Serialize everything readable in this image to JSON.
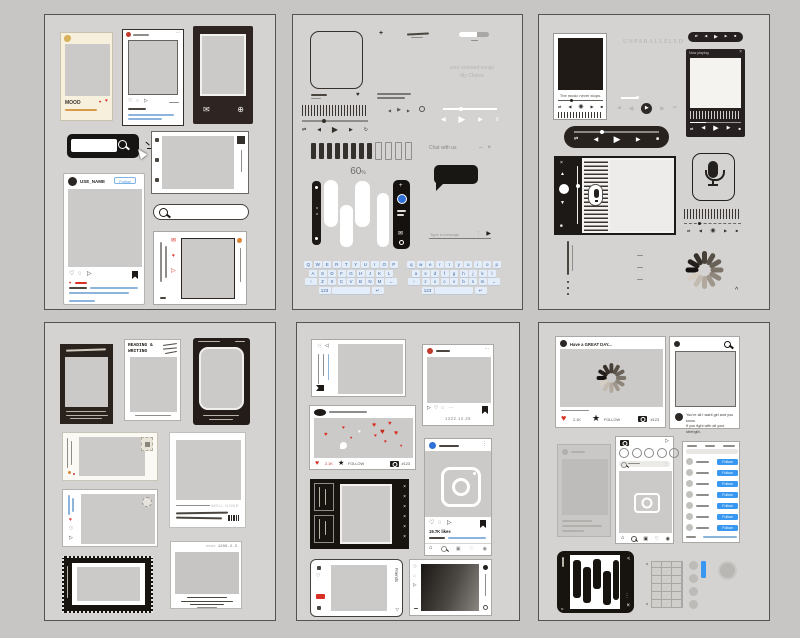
{
  "icons": {
    "heart": "♥",
    "heart_outline": "♡",
    "star": "★",
    "play": "▶",
    "prev": "◀",
    "next": "▶",
    "stop": "■",
    "shuffle": "⇄",
    "repeat": "↻",
    "record": "◉",
    "menu": "≡",
    "dots": "···",
    "dots_v": "⋮",
    "close": "×",
    "minimize": "–",
    "plus": "+",
    "envelope": "✉",
    "globe": "⊕",
    "home": "⌂",
    "circle": "○",
    "grid": "▣",
    "person": "◉",
    "up": "▲",
    "down": "▼",
    "down_outline": "▽",
    "caret": "^",
    "send": "▶",
    "comment": "◌",
    "share": "▷"
  },
  "sheet1": {
    "polaroid_title": "MOOD",
    "ig": {
      "username": "USE_NAME",
      "follow": "Follow"
    }
  },
  "sheet2": {
    "battery_value": "60",
    "battery_unit": "%",
    "chat_title": "Chat with us",
    "input_placeholder": "Type a message",
    "ghost_line1": "your unheard songs",
    "ghost_line2": "My Choice",
    "keyboards": [
      {
        "rows": [
          "QWERTYUIOP",
          "ASDFGHJKL",
          "ZXCVBNM"
        ],
        "shift": "↑",
        "backspace": "←",
        "bottom": [
          "123",
          "",
          "↵"
        ]
      },
      {
        "rows": [
          "qwertyuiop",
          "asdfghjkl",
          "zxcvbnm"
        ],
        "shift": "↑",
        "backspace": "←",
        "bottom": [
          "123",
          "",
          "↵"
        ]
      }
    ]
  },
  "sheet3": {
    "headline": "UNPARALLELED",
    "song_title": "The music never stops.",
    "player_header": "Now playing"
  },
  "sheet4": {
    "frame_title_line1": "READING &",
    "frame_title_line2": "WRITING",
    "stamp_note": "WELL DONE",
    "code_note": "<<<< 1208.2.3"
  },
  "sheet5": {
    "post_date": "1222.12.25",
    "like_count": "2.1K",
    "follow_label": "FOLLOW",
    "camera_label": "#123",
    "likes_text": "19.7K likes",
    "friends_label": "Friends"
  },
  "sheet6": {
    "post_header": "Have a GREAT DAY...",
    "like_count": "2.1K",
    "follow_label": "FOLLOW",
    "camera_label": "#123",
    "caption_line1": "You're all I want girl and you know.",
    "caption_line2": "If you fight with all your strength.",
    "follow_button": "Follow"
  }
}
